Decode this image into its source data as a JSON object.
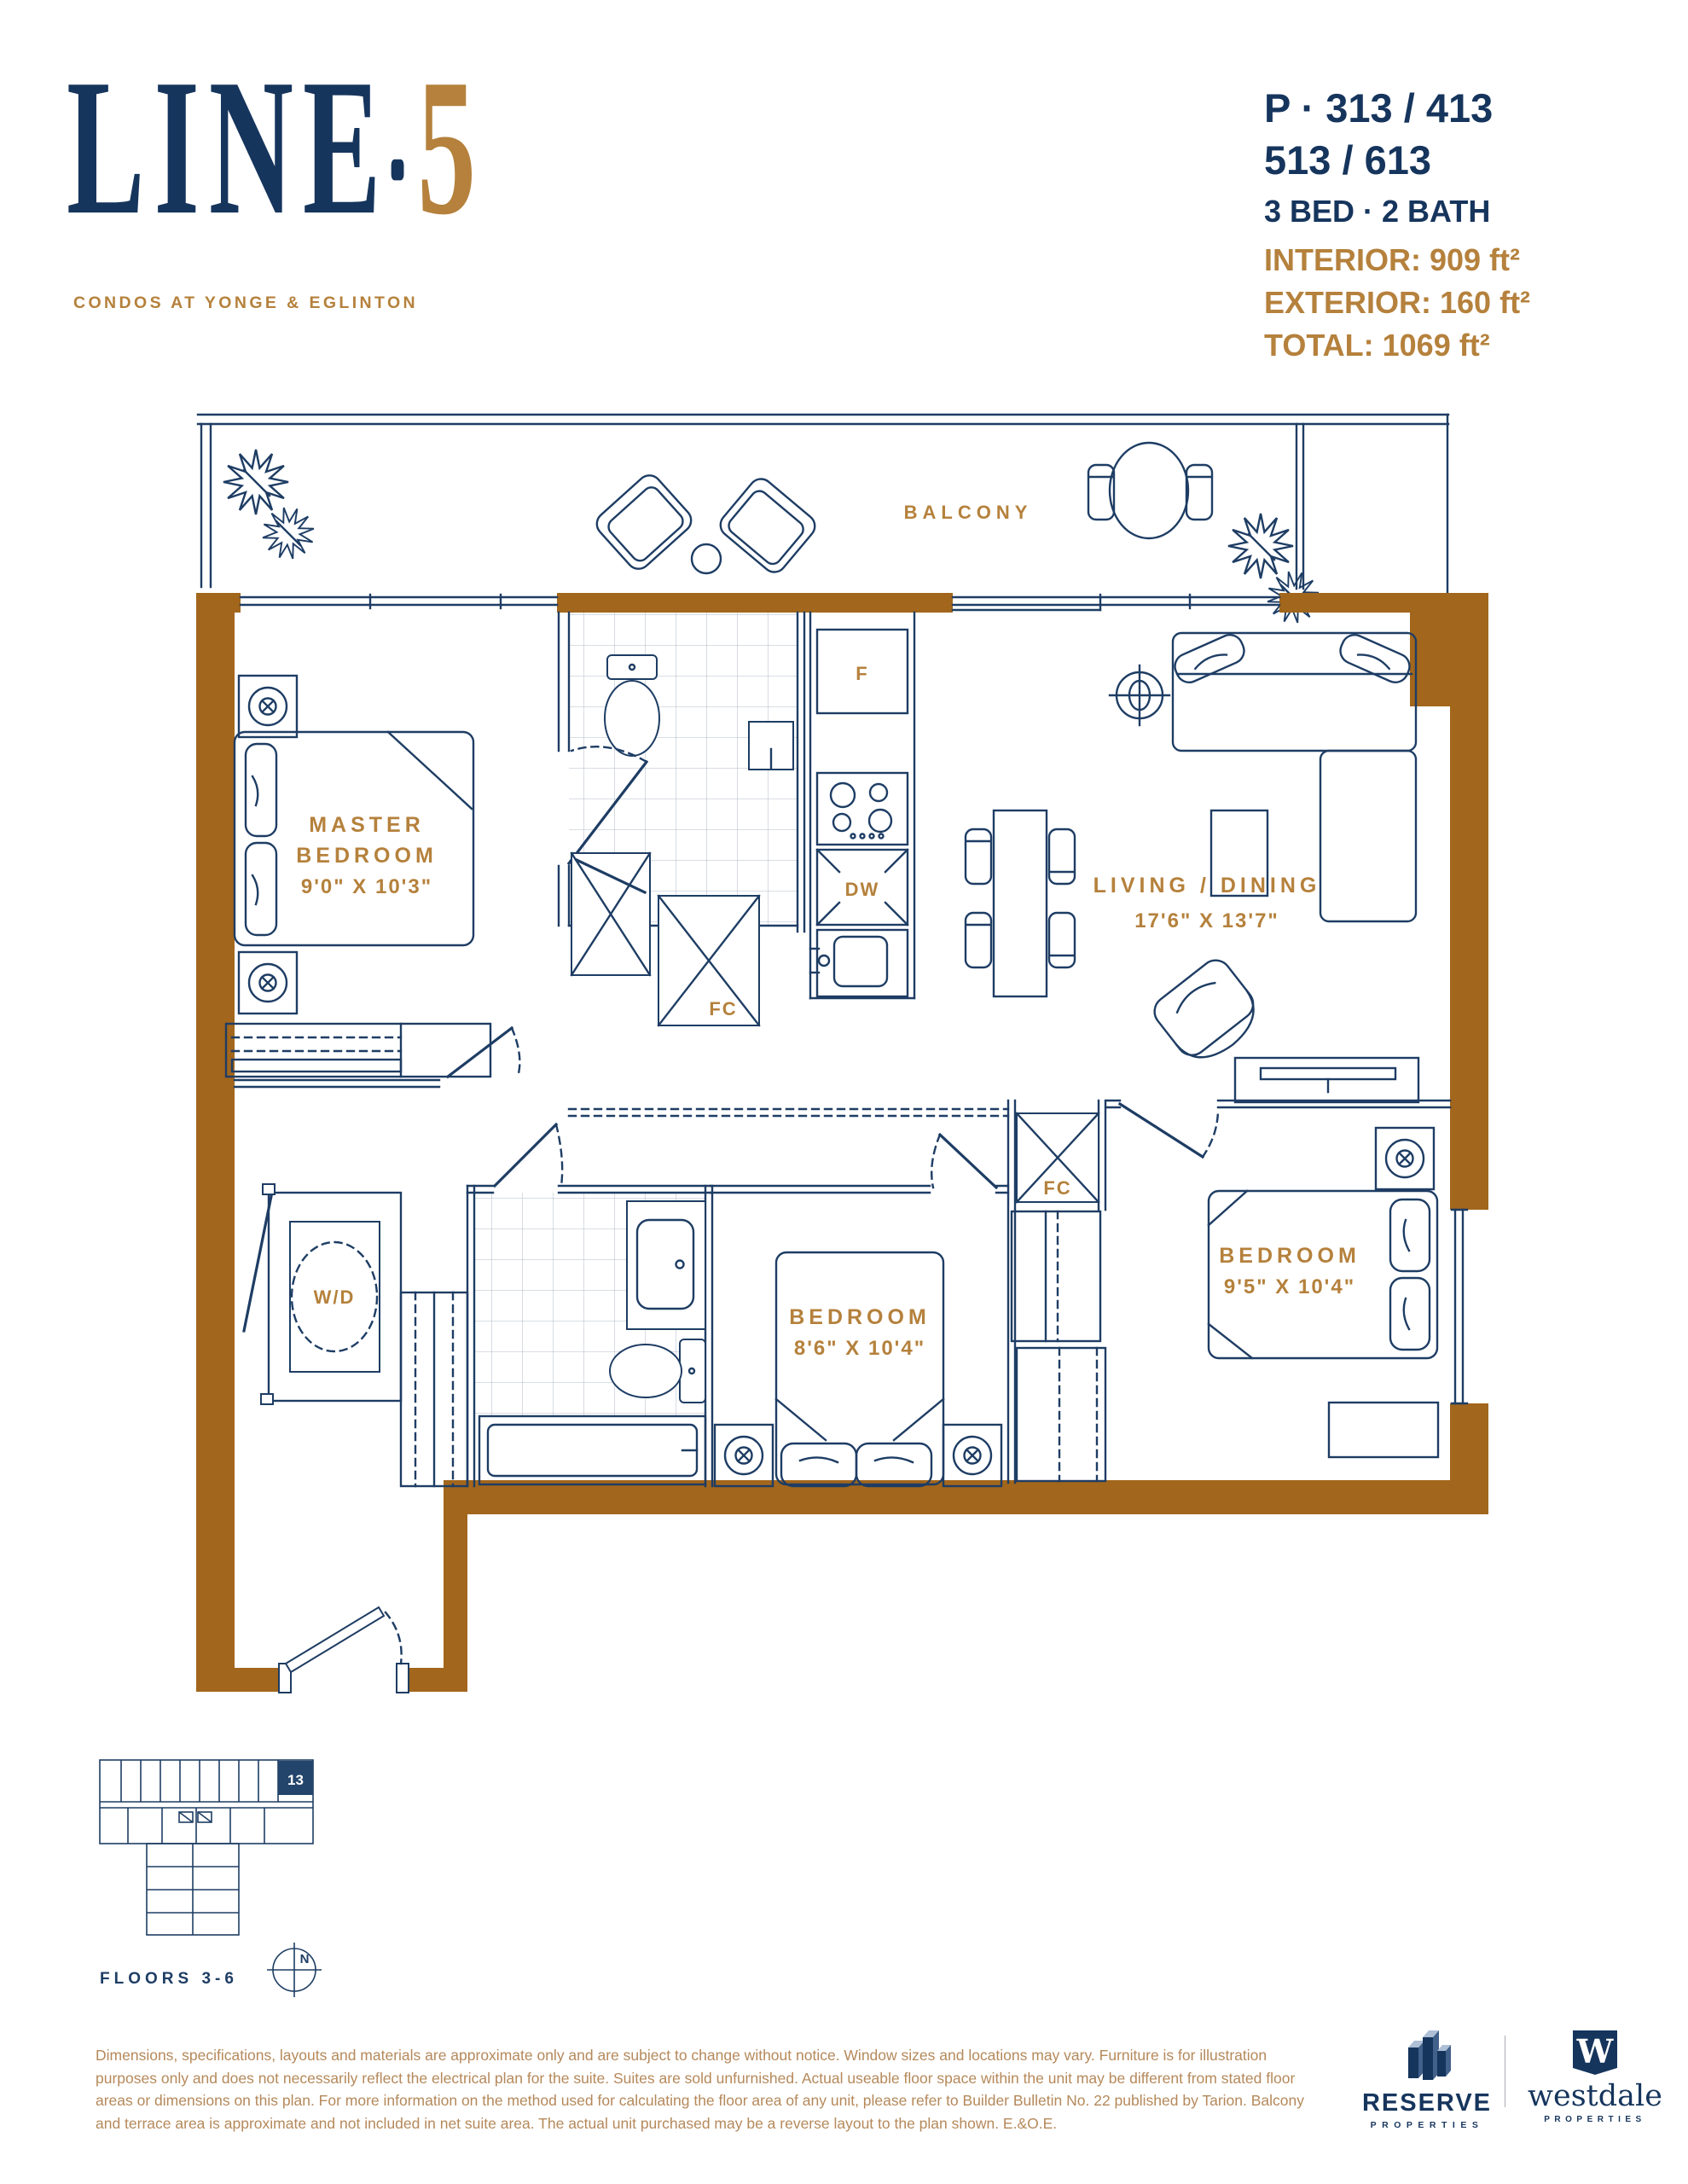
{
  "colors": {
    "navy": "#1e3d64",
    "logo_navy": "#16355d",
    "gold": "#b5813c",
    "wall_brown": "#a2661c",
    "disclaimer_tan": "#b5895b"
  },
  "header": {
    "logo": {
      "line": "LINE",
      "five": "5",
      "tagline": "CONDOS AT YONGE & EGLINTON"
    },
    "unit_info": {
      "plan_line1": "P · 313 / 413",
      "plan_line2": "513 / 613",
      "config": "3 BED · 2 BATH",
      "interior": "INTERIOR: 909 ft²",
      "exterior": "EXTERIOR: 160 ft²",
      "total": "TOTAL: 1069 ft²"
    }
  },
  "plan": {
    "balcony_label": "BALCONY",
    "rooms": {
      "master": {
        "name1": "MASTER",
        "name2": "BEDROOM",
        "dims": "9'0\" X 10'3\""
      },
      "living": {
        "name": "LIVING / DINING",
        "dims": "17'6\" X 13'7\""
      },
      "bedroom2": {
        "name": "BEDROOM",
        "dims": "8'6\" X 10'4\""
      },
      "bedroom3": {
        "name": "BEDROOM",
        "dims": "9'5\" X 10'4\""
      }
    },
    "fixtures": {
      "fridge": "F",
      "dishwasher": "DW",
      "closet1": "FC",
      "closet2": "FC",
      "washer_dryer": "W/D"
    }
  },
  "keyplan": {
    "unit_number": "13",
    "floors_label": "FLOORS 3-6",
    "north": "N"
  },
  "footer": {
    "disclaimer": "Dimensions, specifications, layouts and materials are approximate only and are subject to change without notice. Window sizes and locations may vary. Furniture is for illustration purposes only and does not necessarily reflect the electrical plan for the suite. Suites are sold unfurnished. Actual useable floor space within the unit may be different from stated floor areas or dimensions on this plan. For more information on the method used for calculating the floor area of any unit, please refer to Builder Bulletin No. 22 published by Tarion. Balcony and terrace area is approximate and not included in net suite area. The actual unit purchased may be a reverse layout to the plan shown. E.&O.E.",
    "reserve": {
      "name": "RESERVE",
      "sub": "PROPERTIES"
    },
    "westdale": {
      "mark": "W",
      "name": "westdale",
      "sub": "PROPERTIES"
    }
  }
}
